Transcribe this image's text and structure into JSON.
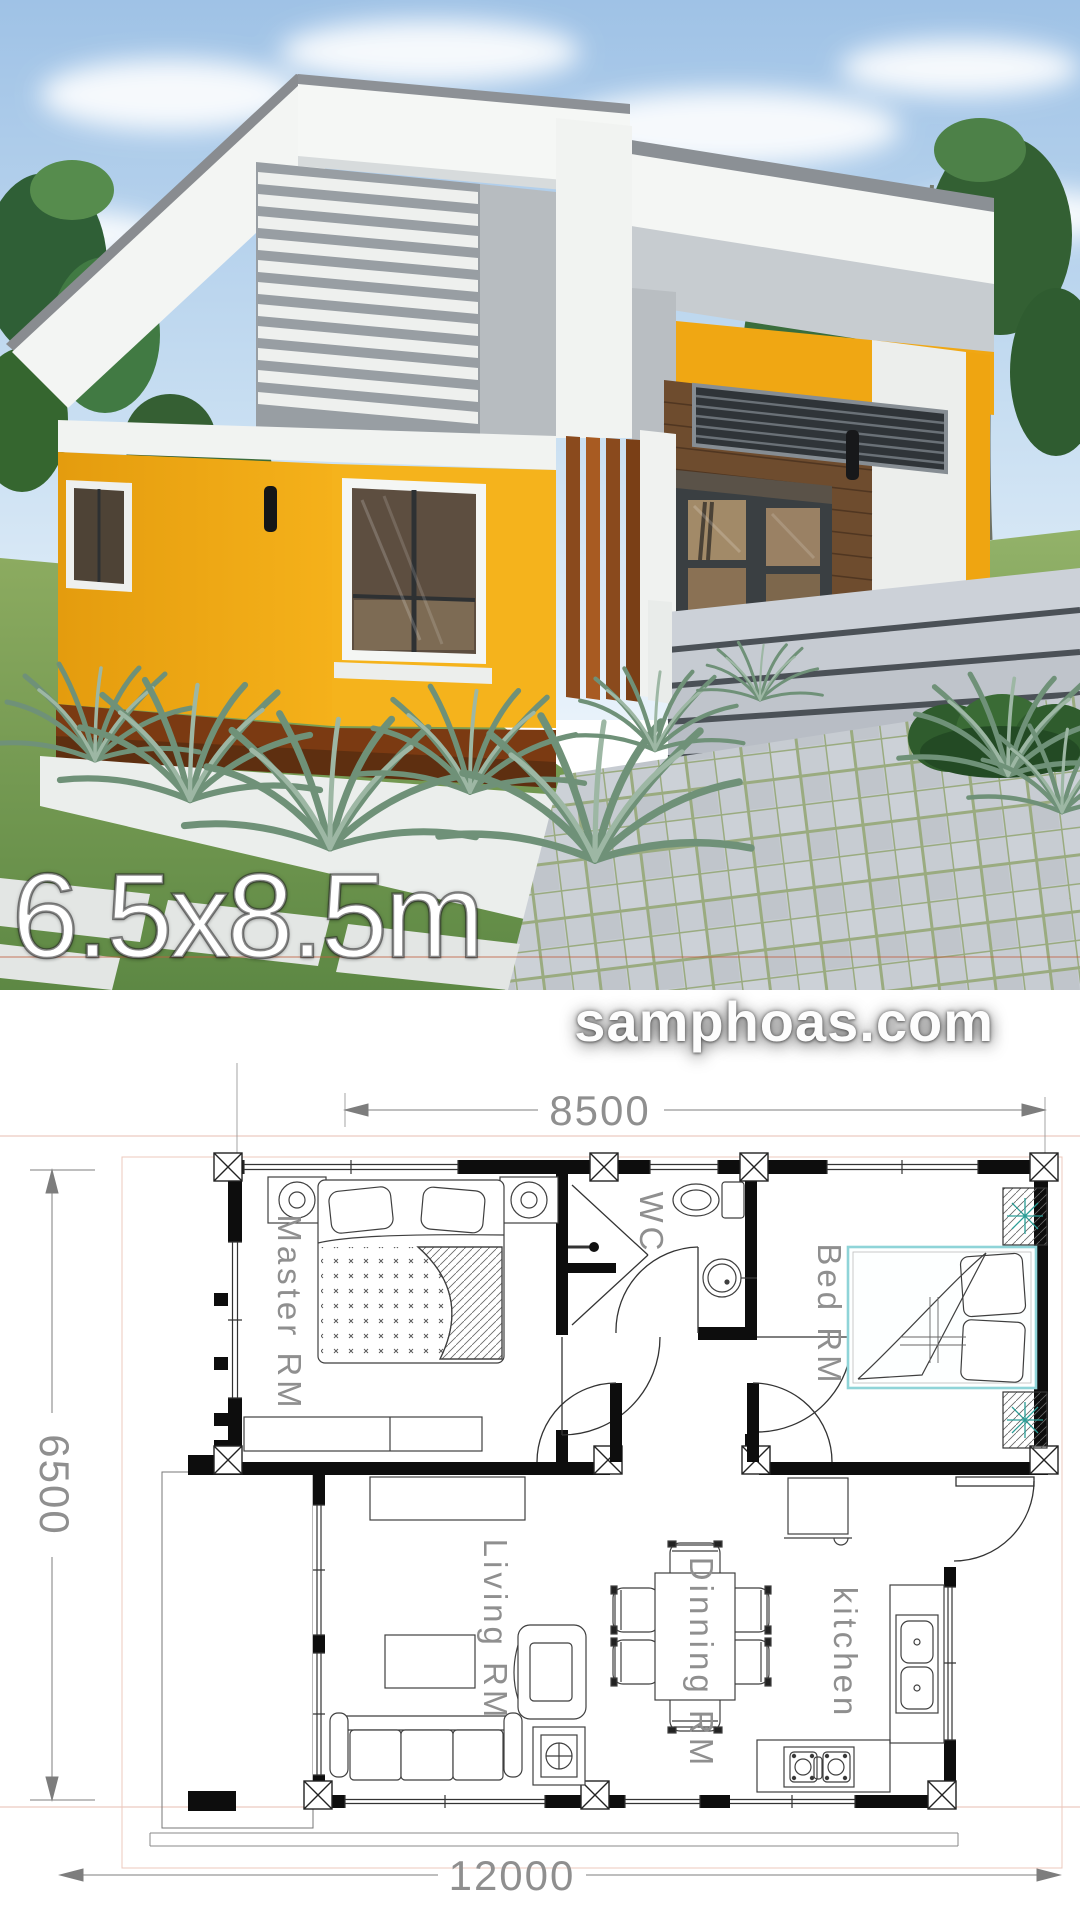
{
  "hero": {
    "size_label": "6.5x8.5m",
    "watermark": "samphoas.com",
    "colors": {
      "sky": "#a9c9e9",
      "roof_white": "#f4f6f4",
      "roof_gray": "#8b9095",
      "wall_gray": "#c7ccd0",
      "accent_yellow": "#f0a713",
      "wood_brown": "#6e4c2e",
      "slat_orange": "#8a4a1d",
      "grass_green": "#83a55c",
      "step_gray": "#c3cad3"
    }
  },
  "floor_plan": {
    "dim_top": "8500",
    "dim_left": "6500",
    "dim_bottom": "12000",
    "rooms": [
      {
        "label": "Master RM"
      },
      {
        "label": "WC"
      },
      {
        "label": "Bed RM"
      },
      {
        "label": "Living RM"
      },
      {
        "label": "Dinning RM"
      },
      {
        "label": "kitchen"
      }
    ],
    "colors": {
      "wall_black": "#0d0d0d",
      "label_gray": "#8f8f8f",
      "bed_accent_cyan": "#8fd4d8",
      "plant_accent_teal": "#2a9d96",
      "guide_pink": "#e7beb2"
    }
  }
}
